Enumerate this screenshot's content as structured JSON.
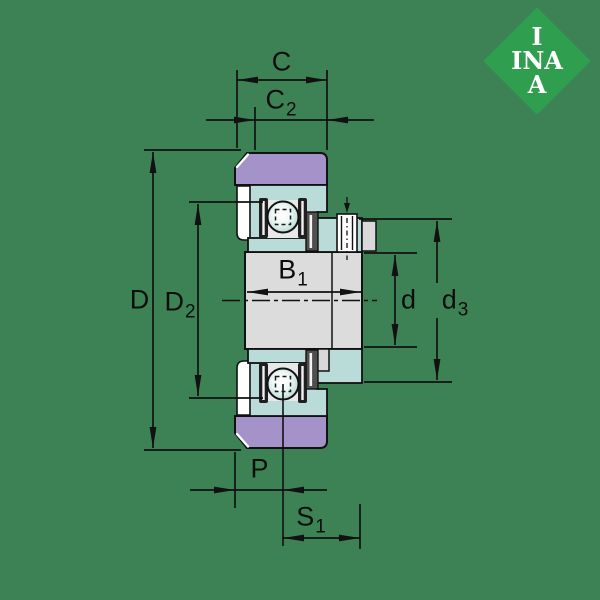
{
  "background_color": "#3d8254",
  "logo": {
    "diamond_color": "#2f9e4f",
    "text_color": "#ffffff",
    "lines": [
      "I",
      "INA",
      "A"
    ]
  },
  "drawing": {
    "colors": {
      "outer_ring": "#a592c8",
      "races_and_collar": "#b9dcd8",
      "inner_ring": "#dcdcdc",
      "outline": "#111111"
    },
    "dimension_labels": {
      "C": {
        "base": "C",
        "sub": ""
      },
      "C2": {
        "base": "C",
        "sub": "2"
      },
      "D": {
        "base": "D",
        "sub": ""
      },
      "D2": {
        "base": "D",
        "sub": "2"
      },
      "B1": {
        "base": "B",
        "sub": "1"
      },
      "d": {
        "base": "d",
        "sub": ""
      },
      "d3": {
        "base": "d",
        "sub": "3"
      },
      "P": {
        "base": "P",
        "sub": ""
      },
      "S1": {
        "base": "S",
        "sub": "1"
      }
    }
  }
}
